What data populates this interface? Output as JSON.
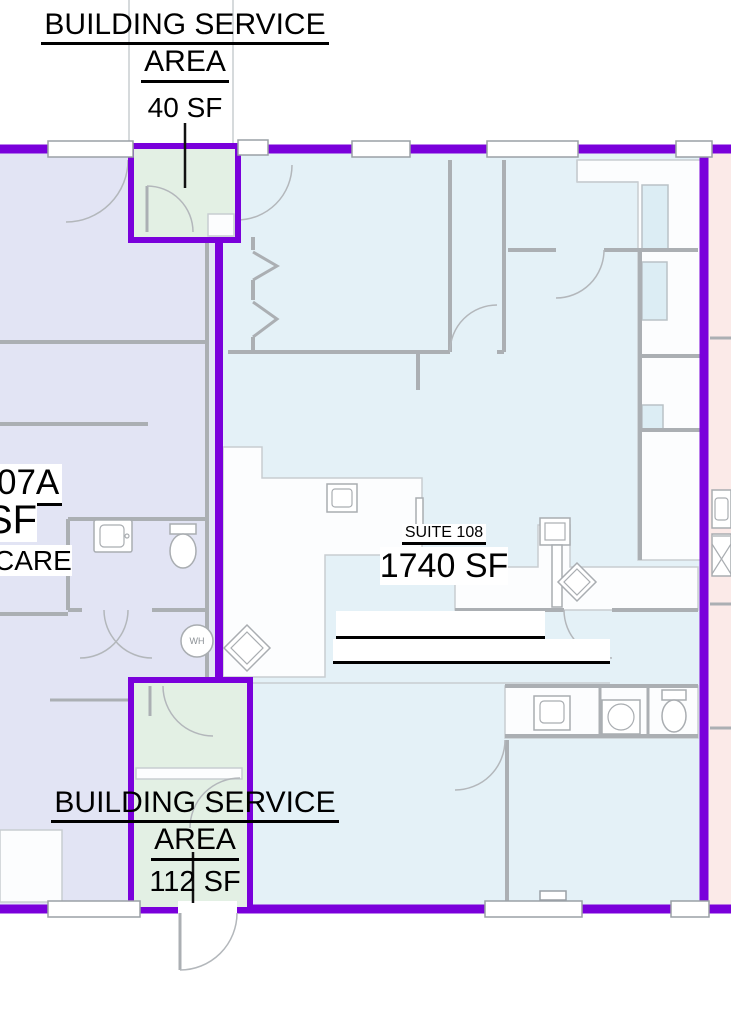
{
  "colors": {
    "wall-purple": "#7A00DB",
    "room-lavender": "#E2E4F4",
    "room-blue": "#E4F1F7",
    "room-green": "#E3F0E4",
    "room-pink": "#FBEAE8",
    "wall-gray": "#ABAFB3",
    "line-light": "#C8CDD1",
    "shelf-blue": "#DCEDF4",
    "ink": "#111111"
  },
  "labels": {
    "service_top": {
      "line1": "BUILDING SERVICE",
      "line2": "AREA",
      "area": "40 SF"
    },
    "service_bottom": {
      "line1": "BUILDING SERVICE",
      "line2": "AREA",
      "area": "112 SF"
    },
    "suite": {
      "name": "SUITE 108",
      "area": "1740 SF"
    },
    "left_partial": {
      "suite_no": "07A",
      "area_sf": "SF",
      "name": "CARE"
    },
    "water_heater": "WH"
  }
}
